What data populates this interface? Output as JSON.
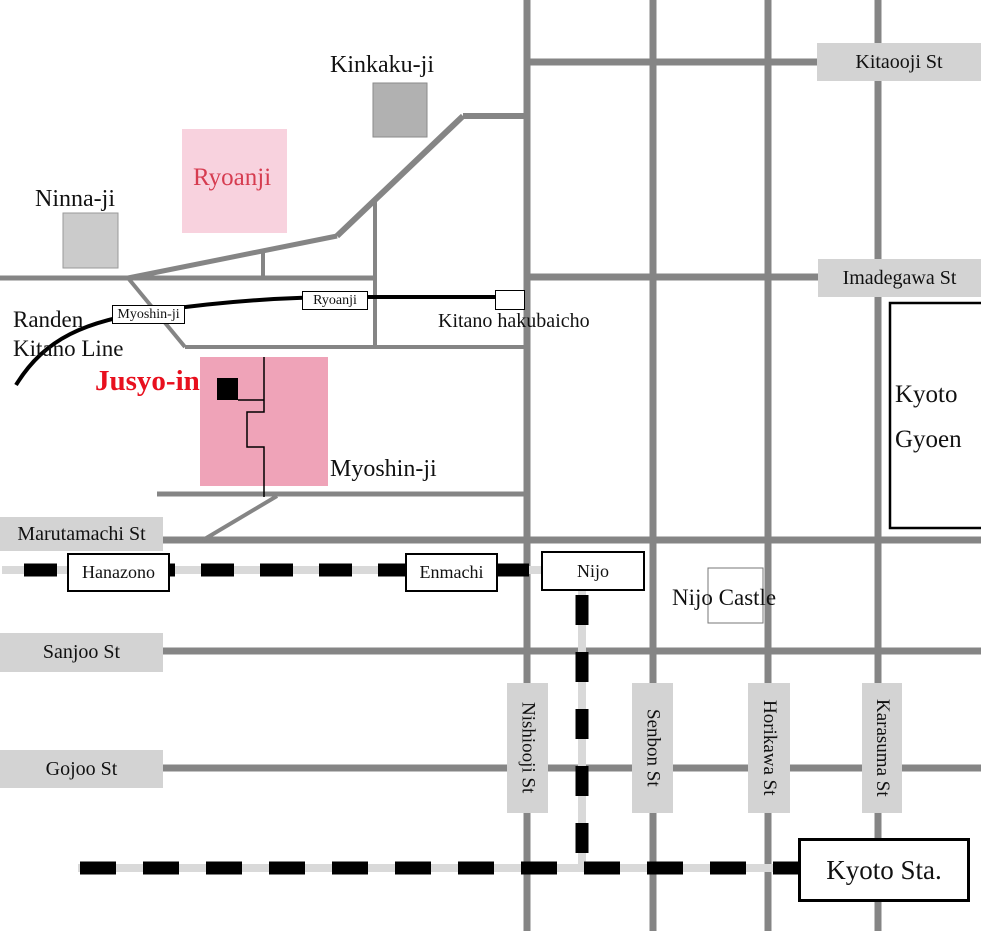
{
  "colors": {
    "road": "#858585",
    "label-bg": "#d3d3d3",
    "rail-backing": "#d9d9d9",
    "rail-dash": "#000000",
    "pink-light": "#f8d2de",
    "pink-dark": "#efa3b8",
    "gray-kinkakuji": "#b1b1b1",
    "gray-ninnaji": "#cbcbcb",
    "red-jusyoin": "#e8101e",
    "red-ryoanji": "#d63c50",
    "text": "#111111"
  },
  "streets": {
    "kitaooji": "Kitaooji St",
    "imadegawa": "Imadegawa St",
    "marutamachi": "Marutamachi St",
    "sanjoo": "Sanjoo St",
    "gojoo": "Gojoo St",
    "nishiooji": "Nishiooji St",
    "senbon": "Senbon St",
    "horikawa": "Horikawa St",
    "karasuma": "Karasuma St"
  },
  "railways": {
    "randen": {
      "name_line1": "Randen",
      "name_line2": "Kitano Line"
    },
    "stations": {
      "myoshinji": "Myoshin-ji",
      "ryoanji": "Ryoanji",
      "kitano_hakubaicho": "Kitano hakubaicho",
      "hanazono": "Hanazono",
      "enmachi": "Enmachi",
      "nijo": "Nijo",
      "kyoto": "Kyoto Sta."
    }
  },
  "landmarks": {
    "kinkakuji": "Kinkaku-ji",
    "ninnaji": "Ninna-ji",
    "ryoanji": "Ryoanji",
    "jusyoin": "Jusyo-in",
    "myoshinji": "Myoshin-ji",
    "nijo_castle": "Nijo Castle",
    "kyoto_gyoen_line1": "Kyoto",
    "kyoto_gyoen_line2": "Gyoen"
  }
}
